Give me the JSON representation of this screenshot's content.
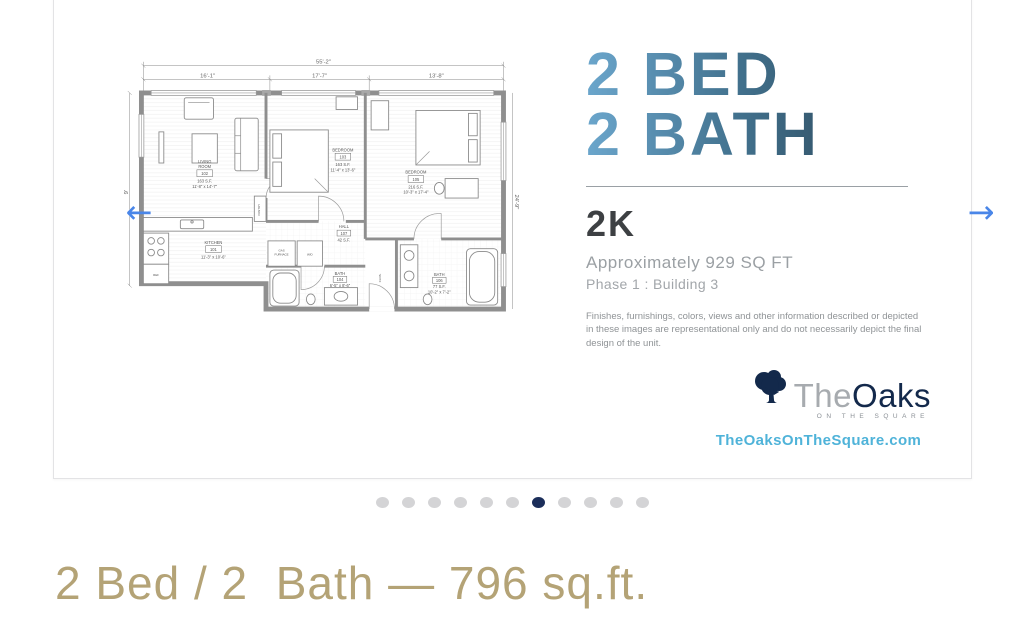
{
  "colors": {
    "accent-arrow": "#4a86e8",
    "headline-light": "#6ba6cc",
    "headline-mid": "#41708c",
    "headline-dark": "#263b4a",
    "caption-color": "#b4a376",
    "dot-active": "#1b2e5a",
    "dot-inactive": "#d4d4d6",
    "website-blue": "#4fb3d9",
    "logo-navy": "#13294b"
  },
  "carousel": {
    "prev_label": "←",
    "next_label": "→",
    "dots": {
      "count": 11,
      "active_index": 6
    }
  },
  "slide": {
    "headline_line1": "2 BED",
    "headline_line2": "2 BATH",
    "unit_code": "2K",
    "area_text": "Approximately 929 SQ FT",
    "phase_text": "Phase 1 : Building 3",
    "disclaimer": "Finishes, furnishings, colors, views and other information described or depicted in these images are representational only and do not necessarily depict the final design of the unit.",
    "logo": {
      "the": "The",
      "oaks": "Oaks",
      "tagline": "ON THE SQUARE"
    },
    "website": "TheOaksOnTheSquare.com"
  },
  "floorplan": {
    "dims": {
      "overall": "55'-2\"",
      "seg1": "16'-1\"",
      "seg2": "17'-7\"",
      "seg3": "13'-8\"",
      "left": "9'",
      "right": "24'-9\""
    },
    "labels": {
      "living1": "LIVING",
      "living2": "ROOM",
      "living_num": "102",
      "living_sf": "163 S.F.",
      "living_dim": "11'-8\" x 14'-7\"",
      "bedroom1": "BEDROOM",
      "bedroom1_num": "103",
      "bedroom1_sf": "163 S.F.",
      "bedroom1_dim": "11'-4\" x 13'-6\"",
      "bedroom2": "BEDROOM",
      "bedroom2_num": "105",
      "bedroom2_sf": "216 S.F.",
      "bedroom2_dim": "10'-3\" x 17'-4\"",
      "kitchen": "KITCHEN",
      "kitchen_num": "101",
      "kitchen_dim": "11'-3\" x 10'-6\"",
      "hall": "HALL",
      "hall_num": "107",
      "hall_sf": "42 S.F.",
      "bath1": "BATH",
      "bath1_num": "104",
      "bath1_dim": "6'-5\" x 8'-6\"",
      "bath2": "BATH",
      "bath2_num": "106",
      "bath2_sf": "77 S.F.",
      "bath2_dim": "10'-2\" x 7'-2\"",
      "wd": "W/D",
      "ref": "REF",
      "furnace1": "GAS",
      "furnace2": "FURNACE",
      "pantry": "PANTRY",
      "clos": "CLOS."
    }
  },
  "caption": {
    "text": "2 Bed / 2  Bath — 796 sq.ft."
  }
}
